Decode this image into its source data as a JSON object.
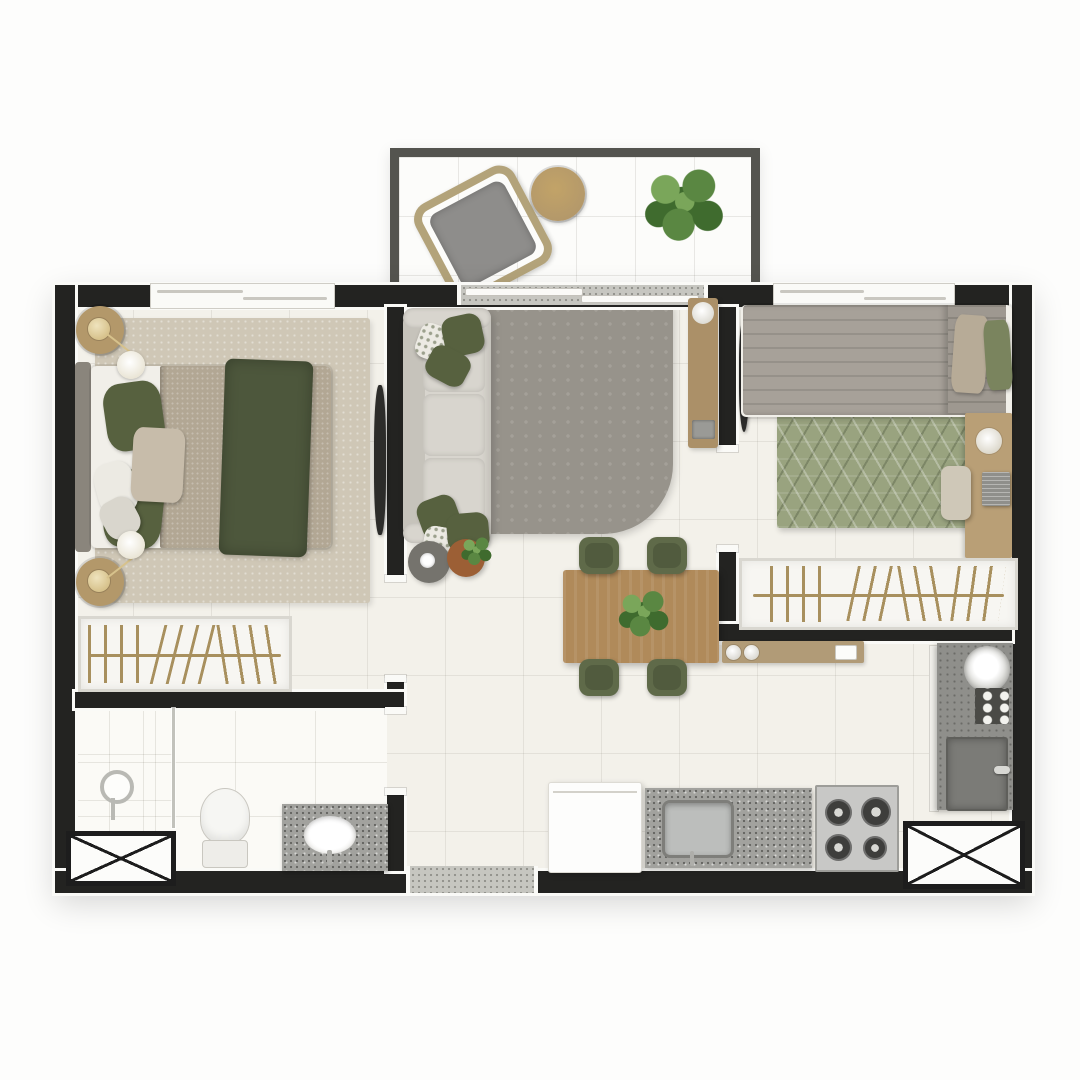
{
  "title": "apartment-floor-plan-top-view",
  "colors": {
    "wall": "#232321",
    "trim": "#fafaf7",
    "floor": "#f3f1ea",
    "floorline": "rgba(90,85,70,0.10)",
    "bathfloor": "#fbfaf6",
    "bathline": "rgba(90,85,70,0.13)",
    "balconyfloor": "#fcfcfa",
    "balconyline": "rgba(90,85,70,0.12)",
    "rail": "#54544f",
    "threshold": "#c6c6c0",
    "xborder": "#1d1d1d",
    "rug1": "#cfc7b6",
    "bedblanket": "#b2a794",
    "throwgreen": "#4d573c",
    "olive": "#57613f",
    "beigepillow": "#c7bcaa",
    "mattress": "#f1efe9",
    "headboard": "#8a857c",
    "woodnight": "#b3986a",
    "gold": "#d7c28c",
    "sofa": "#d8d5ce",
    "sofashade": "#c6c3bb",
    "ruglive": "#97938b",
    "rackwood": "#ab9068",
    "tv": "#2c2c2a",
    "tablewood": "#b08a5a",
    "chairgreen": "#5f6a49",
    "counterwood": "#b19b77",
    "sidedark": "#75736d",
    "siderust": "#9c5f35",
    "quilt": "#a7a199",
    "quilt2": "#9e9890",
    "pillowbeige": "#b7ab97",
    "pillowgreen": "#7a845e",
    "ruggeo": "#99a37f",
    "deskwood": "#b99f76",
    "chairbeige": "#cfc8b8",
    "granite": "#a2a29e",
    "steel": "#bcbebc",
    "stovec": "#c8c8c6",
    "burner": "#3e3e3c",
    "fridge": "#fdfdfc",
    "laundry": "#8f8f8b",
    "machine": "#7b7b77",
    "dotspanel": "#4a4a46",
    "glass": "#c2c2bc",
    "hanger": "#a8905e",
    "wardrobebg": "#f7f6f2",
    "wardrobeborder": "#d9d7d0",
    "plantgreen": "#5a8742",
    "plantdark": "#3f6b2e",
    "plantlight": "#7aa65a",
    "wicker": "#b3a37a",
    "cushion": "#8e8d8b"
  },
  "plan": {
    "view": "top-down-render",
    "rooms": [
      {
        "id": "balcony",
        "furniture": [
          "wicker-armchair",
          "round-side-table",
          "potted-plant"
        ]
      },
      {
        "id": "bedroom-1",
        "furniture": [
          "double-bed",
          "area-rug",
          "nightstand-top",
          "nightstand-bottom",
          "reading-lamp-top",
          "reading-lamp-bottom",
          "wardrobe-hangers",
          "wall-tv"
        ]
      },
      {
        "id": "living-dining",
        "furniture": [
          "three-seat-sofa",
          "throw-pillows",
          "area-rug",
          "tv-panel",
          "speaker",
          "media-console",
          "side-table-gray",
          "side-table-rust",
          "dining-table",
          "centerpiece-plant",
          "dining-chairs-x4",
          "pass-through-counter"
        ]
      },
      {
        "id": "bedroom-2",
        "furniture": [
          "single-bed",
          "quilted-duvet",
          "geometric-rug",
          "desk",
          "desk-lamp",
          "laptop",
          "desk-chair",
          "wardrobe-hangers",
          "wall-tv"
        ]
      },
      {
        "id": "bathroom",
        "furniture": [
          "shower-enclosure",
          "glass-partition",
          "shower-column",
          "toilet",
          "vanity-sink",
          "duct-shaft"
        ]
      },
      {
        "id": "kitchen-laundry",
        "furniture": [
          "refrigerator",
          "sink-counter",
          "gas-stove-4-burners",
          "laundry-counter",
          "laundry-tub",
          "washing-machine",
          "duct-shaft"
        ]
      }
    ],
    "openings": [
      "bedroom-1-window",
      "bedroom-2-window",
      "balcony-sliding-door",
      "entrance-threshold",
      "bedroom-1-door",
      "bedroom-2-door",
      "bathroom-door"
    ]
  }
}
